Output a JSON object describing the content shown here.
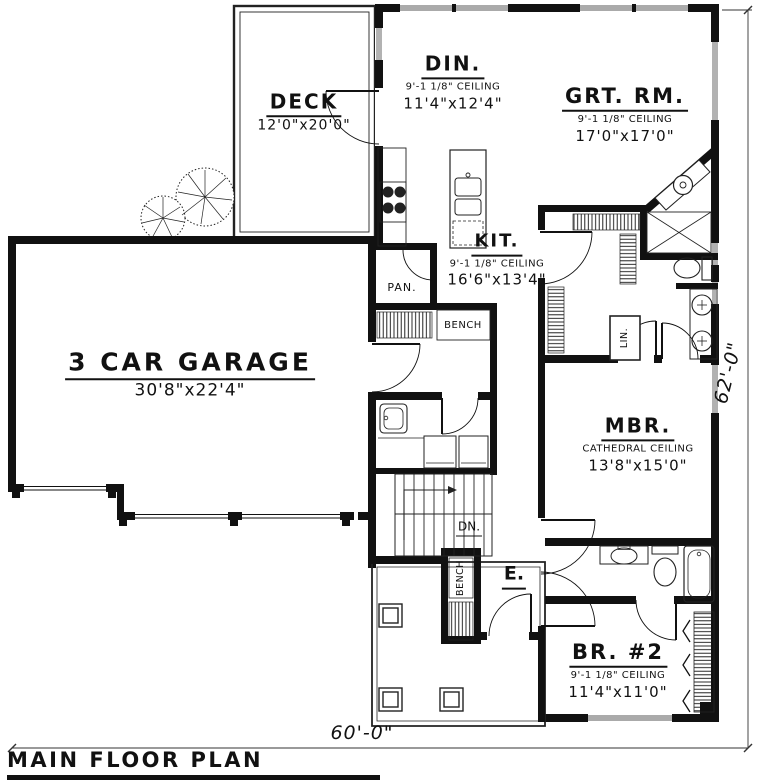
{
  "plan_title": "MAIN FLOOR PLAN",
  "dimensions": {
    "overall_width": "60'-0\"",
    "overall_height": "62'-0\""
  },
  "rooms": {
    "deck": {
      "name": "DECK",
      "size": "12'0\"x20'0\""
    },
    "dining": {
      "name": "DIN.",
      "ceiling": "9'-1 1/8\" CEILING",
      "size": "11'4\"x12'4\""
    },
    "great_room": {
      "name": "GRT. RM.",
      "ceiling": "9'-1 1/8\" CEILING",
      "size": "17'0\"x17'0\""
    },
    "kitchen": {
      "name": "KIT.",
      "ceiling": "9'-1 1/8\" CEILING",
      "size": "16'6\"x13'4\""
    },
    "garage": {
      "name": "3 CAR GARAGE",
      "size": "30'8\"x22'4\""
    },
    "master_bedroom": {
      "name": "MBR.",
      "ceiling": "CATHEDRAL CEILING",
      "size": "13'8\"x15'0\""
    },
    "bedroom_2": {
      "name": "BR. #2",
      "ceiling": "9'-1 1/8\" CEILING",
      "size": "11'4\"x11'0\""
    },
    "pantry": {
      "name": "PAN."
    },
    "entry": {
      "name": "E."
    },
    "linen_closet": {
      "name": "LIN."
    },
    "stairs": {
      "direction_label": "DN."
    },
    "mud_hall": {
      "bench_label": "BENCH"
    },
    "entry_bench": {
      "bench_label": "BENCH"
    }
  }
}
